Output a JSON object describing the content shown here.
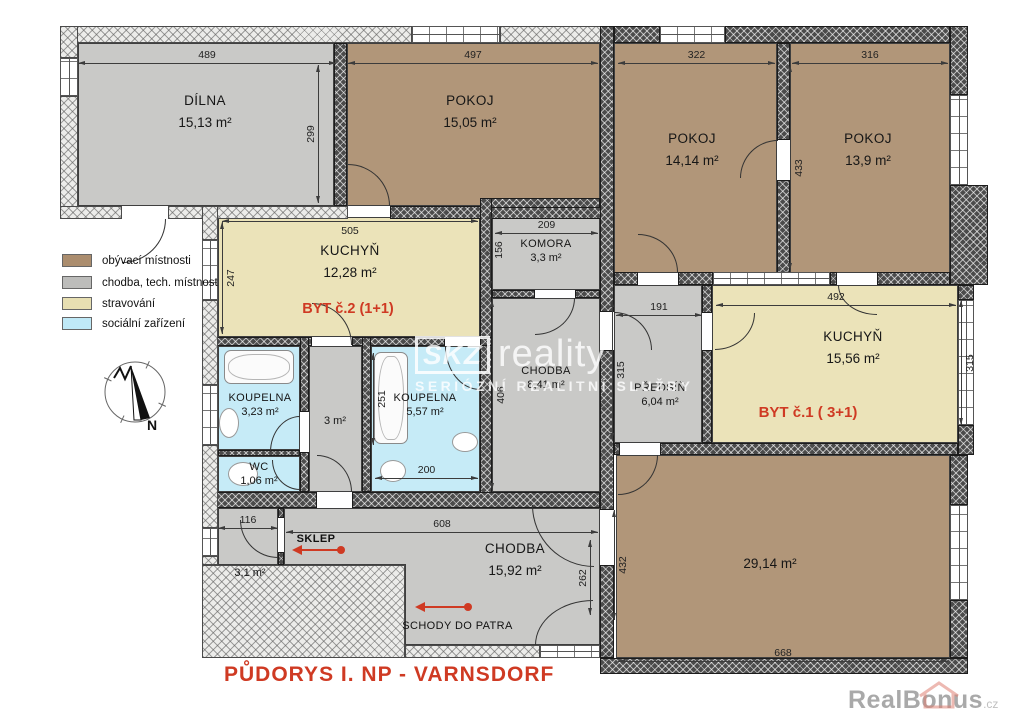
{
  "title": "PŮDORYS I. NP  -  VARNSDORF",
  "apartments": {
    "byt1": "BYT č.1 ( 3+1)",
    "byt2": "BYT č.2 (1+1)"
  },
  "rooms": [
    {
      "name": "DÍLNA",
      "area": "15,13 m²"
    },
    {
      "name": "POKOJ",
      "area": "15,05 m²"
    },
    {
      "name": "POKOJ",
      "area": "14,14 m²"
    },
    {
      "name": "POKOJ",
      "area": "13,9 m²"
    },
    {
      "name": "KUCHYŇ",
      "area": "12,28 m²"
    },
    {
      "name": "KOMORA",
      "area": "3,3 m²"
    },
    {
      "name": "CHODBA",
      "area": "8,41 m²"
    },
    {
      "name": "PŘEDSÍŇ",
      "area": "6,04 m²"
    },
    {
      "name": "KUCHYŇ",
      "area": "15,56 m²"
    },
    {
      "name": "KOUPELNA",
      "area": "3,23 m²"
    },
    {
      "name": "",
      "area": "3 m²"
    },
    {
      "name": "KOUPELNA",
      "area": "5,57 m²"
    },
    {
      "name": "WC",
      "area": "1,06 m²"
    },
    {
      "name": "SKLEP",
      "area": "3,1 m²"
    },
    {
      "name": "CHODBA",
      "area": "15,92 m²"
    },
    {
      "name": "",
      "area": "29,14 m²"
    }
  ],
  "annotations": {
    "schody": "SCHODY DO PATRA"
  },
  "legend": [
    {
      "label": "obývací místnosti",
      "color": "#ab8d6e"
    },
    {
      "label": "chodba, tech. místnost",
      "color": "#bcbcba"
    },
    {
      "label": "stravování",
      "color": "#e7dfb2"
    },
    {
      "label": "sociální zařízení",
      "color": "#bfe9f7"
    }
  ],
  "dimensions": {
    "d489": "489",
    "d299": "299",
    "d497": "497",
    "d322": "322",
    "d316": "316",
    "d433": "433",
    "d505": "505",
    "d247": "247",
    "d209": "209",
    "d156": "156",
    "d191": "191",
    "d315a": "315",
    "d492": "492",
    "d315b": "315",
    "d406": "406",
    "d251": "251",
    "d200": "200",
    "d116": "116",
    "d608": "608",
    "d262": "262",
    "d432": "432",
    "d668": "668"
  },
  "compass": {
    "label": "N"
  },
  "watermark": {
    "logo": "SKZ",
    "brand": "reality",
    "tagline": "SERIÓZNÍ REALITNÍ SLUŽBY"
  },
  "credit": {
    "name": "RealBonus",
    "tld": ".cz"
  },
  "colors": {
    "accent_red": "#cf3a23",
    "wall_dark": "#4b4b4b",
    "wall_light": "#ececea"
  }
}
